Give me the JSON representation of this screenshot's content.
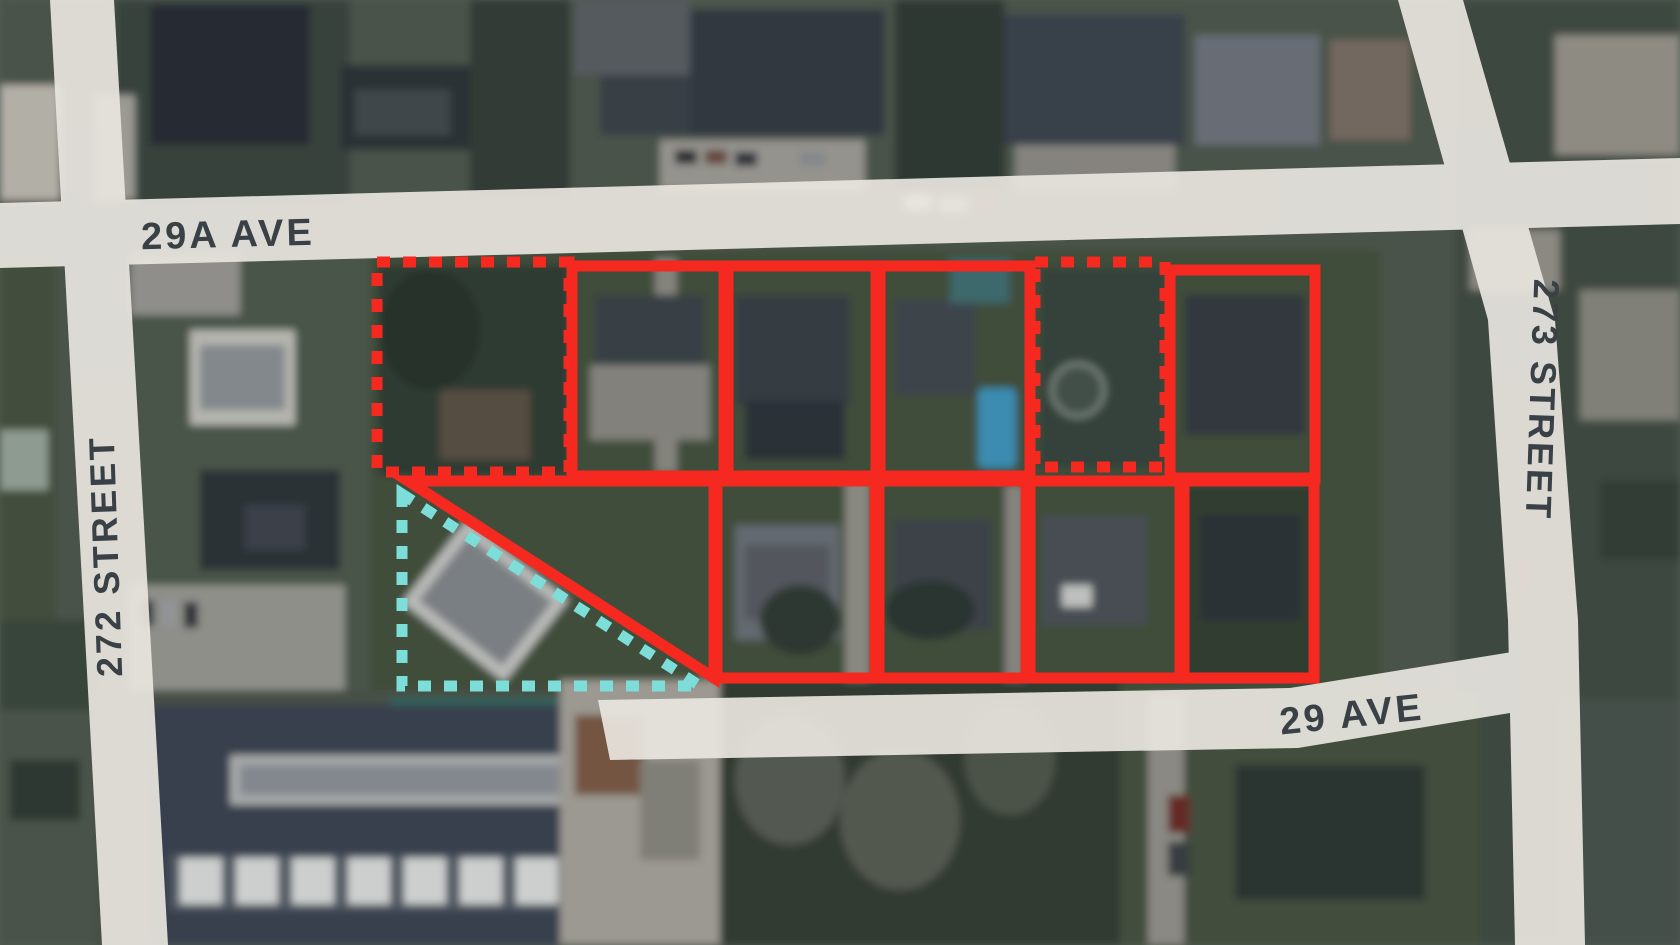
{
  "map": {
    "street_labels": {
      "ave_29a": "29A AVE",
      "st_272": "272 STREET",
      "st_273": "273 STREET",
      "ave_29": "29 AVE"
    },
    "colors": {
      "lot_outline_red": "#f5291f",
      "exclusion_cyan": "#7dded9",
      "road_fill": "#e9e6e0",
      "street_label": "#3a4146"
    },
    "lots": {
      "top_row_styles": [
        "dashed",
        "solid",
        "solid",
        "solid",
        "dashed",
        "solid"
      ],
      "bottom_row_styles": [
        "solid",
        "solid",
        "solid",
        "solid",
        "solid"
      ],
      "cyan_region_style": "dashed"
    }
  }
}
